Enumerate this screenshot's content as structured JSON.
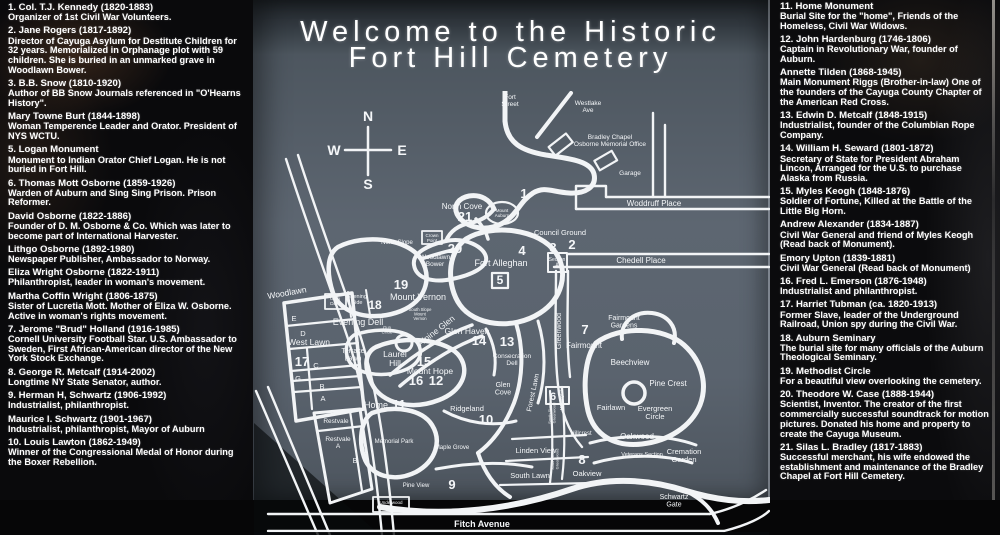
{
  "title": {
    "line1": "Welcome to the Historic",
    "line2": "Fort Hill Cemetery"
  },
  "colors": {
    "background": "#0a0a0c",
    "panel": "#5d6671",
    "map_line": "#f2f4f6",
    "text": "#ffffff"
  },
  "left_legend": {
    "entries": [
      {
        "name": "1. Col. T.J. Kennedy (1820-1883)",
        "desc": "Organizer of 1st Civil War Volunteers."
      },
      {
        "name": "2. Jane Rogers (1817-1892)",
        "desc": "Director of Cayuga Asylum for Destitute Children for 32 years. Memorialized in Orphanage plot with 59 children. She is buried in an unmarked grave in Woodlawn Bower."
      },
      {
        "name": "3. B.B. Snow (1810-1920)",
        "desc": "Author of BB Snow Journals referenced in \"O'Hearns History\"."
      },
      {
        "name": "Mary Towne Burt (1844-1898)",
        "desc": "Woman Temperence Leader and Orator. President of NYS WCTU."
      },
      {
        "name": "5. Logan Monument",
        "desc": "Monument to Indian Orator Chief Logan. He is not buried in Fort Hill."
      },
      {
        "name": "6. Thomas Mott Osborne (1859-1926)",
        "desc": "Warden of Auburn and Sing Sing Prison. Prison Reformer."
      },
      {
        "name": "David Osborne (1822-1886)",
        "desc": "Founder of D. M. Osborne & Co. Which was later to become part of International Harvester."
      },
      {
        "name": "Lithgo Osborne (1892-1980)",
        "desc": "Newspaper Publisher, Ambassador to Norway."
      },
      {
        "name": "Eliza Wright Osborne (1822-1911)",
        "desc": "Philanthropist, leader in woman's movement."
      },
      {
        "name": "Martha Coffin Wright (1806-1875)",
        "desc": "Sister of Lucretia Mott. Mother of Eliza W. Osborne. Active in woman's rights movement."
      },
      {
        "name": "7. Jerome \"Brud\" Holland (1916-1985)",
        "desc": "Cornell University Football Star. U.S. Ambassador to Sweden, First African-American director of the New York Stock Exchange."
      },
      {
        "name": "8. George R. Metcalf (1914-2002)",
        "desc": "Longtime NY State Senator, author."
      },
      {
        "name": "9. Herman H, Schwartz (1906-1992)",
        "desc": "Industrialist, philanthropist."
      },
      {
        "name": "Maurice  I. Schwartz (1901-1967)",
        "desc": "Industrialist, philanthropist, Mayor of Auburn"
      },
      {
        "name": "10. Louis Lawton (1862-1949)",
        "desc": "Winner of the Congressional Medal of Honor during the Boxer Rebellion."
      }
    ]
  },
  "right_legend": {
    "entries": [
      {
        "name": "11. Home Monument",
        "desc": "Burial Site for the \"home\", Friends of the Homeless, Civil War Widows."
      },
      {
        "name": "12. John Hardenburg (1746-1806)",
        "desc": "Captain in Revolutionary War, founder of Auburn."
      },
      {
        "name": "Annette Tilden (1868-1945)",
        "desc": "Main Monument Riggs (Brother-in-law) One of the founders of the Cayuga County Chapter of the American Red Cross."
      },
      {
        "name": "13. Edwin D. Metcalf (1848-1915)",
        "desc": "Industrialist, founder of the Columbian Rope Company."
      },
      {
        "name": "14. William H. Seward (1801-1872)",
        "desc": "Secretary of State for President Abraham Lincon, Arranged for the U.S. to purchase Alaska from Russia."
      },
      {
        "name": "15. Myles Keogh (1848-1876)",
        "desc": "Soldier of Fortune, Killed at the Battle of the Little Big Horn."
      },
      {
        "name": "Andrew Alexander (1834-1887)",
        "desc": "Civil War General and friend of Myles Keogh (Read back of Monument)."
      },
      {
        "name": "Emory Upton (1839-1881)",
        "desc": "Civil War General (Read back of Monument)"
      },
      {
        "name": "16. Fred L. Emerson (1876-1948)",
        "desc": "Industrialist and philanthropist."
      },
      {
        "name": "17. Harriet Tubman (ca. 1820-1913)",
        "desc": "Former Slave, leader of the Underground Railroad, Union spy during the Civil War."
      },
      {
        "name": "18. Auburn Seminary",
        "desc": "The burial site for many officials of the Auburn Theological Seminary."
      },
      {
        "name": "19. Methodist Circle",
        "desc": "For a beautiful view overlooking the cemetery."
      },
      {
        "name": "20. Theodore W. Case (1888-1944)",
        "desc": "Scientist, Inventor. The creator of the first commercially successful soundtrack for motion pictures. Donated his home and property to create the Cayuga Museum."
      },
      {
        "name": "21. Silas L. Bradley (1817-1883)",
        "desc": "Successful merchant, his wife endowed the establishment and maintenance of the Bradley Chapel at Fort Hill Cemetery."
      }
    ]
  },
  "map": {
    "labels": [
      {
        "t": "N",
        "x": 114,
        "y": 30,
        "s": 14,
        "b": 1,
        "dn": "compass-north"
      },
      {
        "t": "S",
        "x": 114,
        "y": 98,
        "s": 14,
        "b": 1,
        "dn": "compass-south"
      },
      {
        "t": "W",
        "x": 80,
        "y": 64,
        "s": 14,
        "b": 1,
        "dn": "compass-west"
      },
      {
        "t": "E",
        "x": 148,
        "y": 64,
        "s": 14,
        "b": 1,
        "dn": "compass-east"
      },
      {
        "t": "Fort\nStreet",
        "x": 256,
        "y": 8,
        "s": 6.5,
        "dn": "label-fort-street"
      },
      {
        "t": "Westlake\nAve",
        "x": 334,
        "y": 14,
        "s": 6.5,
        "dn": "label-westlake-ave"
      },
      {
        "t": "Bradley Chapel\nOsborne Memorial Office",
        "x": 356,
        "y": 48,
        "s": 6.5,
        "dn": "label-bradley-chapel-osborne-memorial-office"
      },
      {
        "t": "Garage",
        "x": 376,
        "y": 84,
        "s": 6.5,
        "dn": "label-garage"
      },
      {
        "t": "Woddruff Place",
        "x": 400,
        "y": 115,
        "s": 8,
        "dn": "label-woddruff-place"
      },
      {
        "t": "Chedell Place",
        "x": 387,
        "y": 172,
        "s": 8,
        "dn": "label-chedell-place"
      },
      {
        "t": "Council Ground",
        "x": 306,
        "y": 144,
        "s": 7.5,
        "dn": "label-council-ground"
      },
      {
        "t": "Woodlawn",
        "x": 14,
        "y": 208,
        "s": 8.5,
        "r": -10,
        "a": "start",
        "dn": "label-woodlawn-street"
      },
      {
        "t": "Fitch Avenue",
        "x": 228,
        "y": 436,
        "s": 9,
        "b": 1,
        "dn": "label-fitch-avenue"
      },
      {
        "t": "Schwartz\nGate",
        "x": 420,
        "y": 408,
        "s": 7,
        "dn": "label-schwartz-gate"
      },
      {
        "t": "Underwood\nGate",
        "x": 137,
        "y": 413,
        "s": 4.5,
        "dn": "label-underwood-gate"
      },
      {
        "t": "1",
        "x": 270,
        "y": 107,
        "s": 13,
        "b": 1,
        "dn": "marker-1"
      },
      {
        "t": "2",
        "x": 318,
        "y": 158,
        "s": 13,
        "b": 1,
        "dn": "marker-2"
      },
      {
        "t": "3",
        "x": 299,
        "y": 161,
        "s": 13,
        "b": 1,
        "dn": "marker-3"
      },
      {
        "t": "4",
        "x": 268,
        "y": 164,
        "s": 13,
        "b": 1,
        "dn": "marker-4"
      },
      {
        "t": "5",
        "x": 246,
        "y": 193,
        "s": 12,
        "b": 1,
        "dn": "marker-5"
      },
      {
        "t": "6",
        "x": 299,
        "y": 309,
        "s": 11,
        "b": 1,
        "dn": "marker-6"
      },
      {
        "t": "7",
        "x": 331,
        "y": 243,
        "s": 13,
        "b": 1,
        "dn": "marker-7"
      },
      {
        "t": "8",
        "x": 328,
        "y": 373,
        "s": 13,
        "b": 1,
        "dn": "marker-8"
      },
      {
        "t": "9",
        "x": 198,
        "y": 398,
        "s": 13,
        "b": 1,
        "dn": "marker-9"
      },
      {
        "t": "10",
        "x": 232,
        "y": 333,
        "s": 13,
        "b": 1,
        "dn": "marker-10"
      },
      {
        "t": "11",
        "x": 145,
        "y": 318,
        "s": 13,
        "b": 1,
        "dn": "marker-11"
      },
      {
        "t": "12",
        "x": 182,
        "y": 294,
        "s": 13,
        "b": 1,
        "dn": "marker-12"
      },
      {
        "t": "13",
        "x": 253,
        "y": 255,
        "s": 13,
        "b": 1,
        "dn": "marker-13"
      },
      {
        "t": "14",
        "x": 225,
        "y": 254,
        "s": 13,
        "b": 1,
        "dn": "marker-14"
      },
      {
        "t": "15",
        "x": 170,
        "y": 275,
        "s": 13,
        "b": 1,
        "dn": "marker-15"
      },
      {
        "t": "16",
        "x": 162,
        "y": 294,
        "s": 13,
        "b": 1,
        "dn": "marker-16"
      },
      {
        "t": "17",
        "x": 48,
        "y": 275,
        "s": 13,
        "b": 1,
        "dn": "marker-17"
      },
      {
        "t": "18",
        "x": 121,
        "y": 218,
        "s": 12,
        "b": 1,
        "dn": "marker-18"
      },
      {
        "t": "19",
        "x": 147,
        "y": 198,
        "s": 13,
        "b": 1,
        "dn": "marker-19"
      },
      {
        "t": "20",
        "x": 201,
        "y": 162,
        "s": 13,
        "b": 1,
        "dn": "marker-20"
      },
      {
        "t": "21",
        "x": 211,
        "y": 130,
        "s": 13,
        "b": 1,
        "dn": "marker-21"
      },
      {
        "t": "North Cove",
        "x": 208,
        "y": 118,
        "s": 8,
        "dn": "label-north-cove"
      },
      {
        "t": "Mount\nAuburn",
        "x": 248,
        "y": 121,
        "s": 4.5,
        "dn": "label-mount-auburn"
      },
      {
        "t": "North Slope",
        "x": 143,
        "y": 153,
        "s": 6,
        "dn": "label-north-slope"
      },
      {
        "t": "Crown\nPoint",
        "x": 178,
        "y": 146,
        "s": 4.5,
        "dn": "label-crown-point"
      },
      {
        "t": "Woodlawn\nBower",
        "x": 181,
        "y": 168,
        "s": 6.5,
        "dn": "label-woodlawn-bower"
      },
      {
        "t": "Fort Alleghan",
        "x": 247,
        "y": 175,
        "s": 9,
        "dn": "label-fort-alleghan"
      },
      {
        "t": "Section\nA",
        "x": 303,
        "y": 170,
        "s": 5,
        "dn": "label-section-a"
      },
      {
        "t": "Mount Vernon",
        "x": 164,
        "y": 209,
        "s": 9,
        "dn": "label-mount-vernon"
      },
      {
        "t": "Glen\nDale",
        "x": 81,
        "y": 209,
        "s": 4.8,
        "dn": "label-glen-dale"
      },
      {
        "t": "Evening\nSide",
        "x": 103,
        "y": 207,
        "s": 5.5,
        "dn": "label-evening-side"
      },
      {
        "t": "Evening Dell",
        "x": 104,
        "y": 234,
        "s": 9,
        "dn": "label-evening-dell"
      },
      {
        "t": "E",
        "x": 40,
        "y": 230,
        "s": 7.5,
        "dn": "label-section-e"
      },
      {
        "t": "D",
        "x": 49,
        "y": 245,
        "s": 7.5,
        "dn": "label-section-d"
      },
      {
        "t": "West Lawn",
        "x": 55,
        "y": 254,
        "s": 8.5,
        "dn": "label-west-lawn"
      },
      {
        "t": "C",
        "x": 62,
        "y": 277,
        "s": 7.5,
        "dn": "label-section-c"
      },
      {
        "t": "G",
        "x": 44,
        "y": 290,
        "s": 7.5,
        "dn": "label-section-g"
      },
      {
        "t": "B",
        "x": 68,
        "y": 298,
        "s": 7.5,
        "dn": "label-section-b"
      },
      {
        "t": "A",
        "x": 69,
        "y": 310,
        "s": 7.5,
        "dn": "label-section-a-west-lawn"
      },
      {
        "t": "Terrace\nLawn",
        "x": 99,
        "y": 262,
        "s": 7,
        "dn": "label-terrace-lawn"
      },
      {
        "t": "Laurel\nHill",
        "x": 141,
        "y": 266,
        "s": 8.5,
        "dn": "label-laurel-hill"
      },
      {
        "t": "Alpine Glen",
        "x": 184,
        "y": 242,
        "s": 8.5,
        "r": -38,
        "dn": "label-alpine-glen"
      },
      {
        "t": "South Slope\nMount\nVernon",
        "x": 166,
        "y": 220,
        "s": 4.2,
        "dn": "label-south-slope-mount-vernon"
      },
      {
        "t": "Gun\nCircle",
        "x": 133,
        "y": 238,
        "s": 4.2,
        "dn": "label-gun-circle"
      },
      {
        "t": "Glen Haven",
        "x": 213,
        "y": 243,
        "s": 8.5,
        "dn": "label-glen-haven"
      },
      {
        "t": "Mount Hope",
        "x": 176,
        "y": 283,
        "s": 8.5,
        "dn": "label-mount-hope"
      },
      {
        "t": "Consecration\nDell",
        "x": 258,
        "y": 267,
        "s": 6.5,
        "dn": "label-consecration-dell"
      },
      {
        "t": "Glen\nCove",
        "x": 249,
        "y": 296,
        "s": 7,
        "dn": "label-glen-cove"
      },
      {
        "t": "Forest Lawn",
        "x": 281,
        "y": 302,
        "s": 7,
        "r": -78,
        "dn": "label-forest-lawn"
      },
      {
        "t": "Greenwood",
        "x": 307,
        "y": 240,
        "s": 7,
        "r": -90,
        "dn": "label-greenwood"
      },
      {
        "t": "Fairmount",
        "x": 330,
        "y": 257,
        "s": 8,
        "dn": "label-fairmount"
      },
      {
        "t": "Fairmount\nGardens",
        "x": 370,
        "y": 229,
        "s": 7,
        "dn": "label-fairmount-gardens"
      },
      {
        "t": "Home",
        "x": 122,
        "y": 317,
        "s": 9,
        "dn": "label-home"
      },
      {
        "t": "Ridgeland",
        "x": 213,
        "y": 320,
        "s": 7.5,
        "dn": "label-ridgeland"
      },
      {
        "t": "Memorial Park",
        "x": 140,
        "y": 352,
        "s": 6,
        "dn": "label-memorial-park"
      },
      {
        "t": "Maple Grove",
        "x": 198,
        "y": 358,
        "s": 6,
        "dn": "label-maple-grove"
      },
      {
        "t": "Morningside",
        "x": 309,
        "y": 308,
        "s": 4.2,
        "r": -90,
        "dn": "label-morningside"
      },
      {
        "t": "South Slope\nGreenwood",
        "x": 297,
        "y": 322,
        "s": 4,
        "r": -90,
        "dn": "label-south-slope-greenwood-upper"
      },
      {
        "t": "Hillcrest",
        "x": 327,
        "y": 344,
        "s": 6,
        "dn": "label-hillcrest"
      },
      {
        "t": "Beechview",
        "x": 376,
        "y": 274,
        "s": 8,
        "dn": "label-beechview"
      },
      {
        "t": "Pine Crest",
        "x": 414,
        "y": 295,
        "s": 8,
        "dn": "label-pine-crest"
      },
      {
        "t": "Fairlawn",
        "x": 357,
        "y": 319,
        "s": 7.5,
        "dn": "label-fairlawn"
      },
      {
        "t": "Evergreen\nCircle",
        "x": 401,
        "y": 320,
        "s": 7.5,
        "dn": "label-evergreen-circle"
      },
      {
        "t": "Oakwood",
        "x": 383,
        "y": 348,
        "s": 8,
        "dn": "label-oakwood"
      },
      {
        "t": "Oakview",
        "x": 333,
        "y": 385,
        "s": 7.5,
        "dn": "label-oakview"
      },
      {
        "t": "South Slope\nGreenwood",
        "x": 300,
        "y": 368,
        "s": 4,
        "r": -90,
        "dn": "label-south-slope-greenwood-lower"
      },
      {
        "t": "Veterans Section",
        "x": 388,
        "y": 365,
        "s": 5.5,
        "dn": "label-veterans-section"
      },
      {
        "t": "Linden View",
        "x": 282,
        "y": 362,
        "s": 7.5,
        "dn": "label-linden-view"
      },
      {
        "t": "South Lawn",
        "x": 276,
        "y": 387,
        "s": 7.5,
        "dn": "label-south-lawn"
      },
      {
        "t": "Pine View",
        "x": 162,
        "y": 396,
        "s": 6,
        "dn": "label-pine-view"
      },
      {
        "t": "Cremation\nGarden",
        "x": 430,
        "y": 363,
        "s": 7.5,
        "dn": "label-cremation-garden"
      },
      {
        "t": "Restvale",
        "x": 82,
        "y": 332,
        "s": 6.5,
        "dn": "label-restvale-upper"
      },
      {
        "t": "Restvale\nA",
        "x": 84,
        "y": 350,
        "s": 6.5,
        "dn": "label-restvale-a"
      },
      {
        "t": "B",
        "x": 101,
        "y": 372,
        "s": 7,
        "dn": "label-restvale-b"
      }
    ]
  }
}
